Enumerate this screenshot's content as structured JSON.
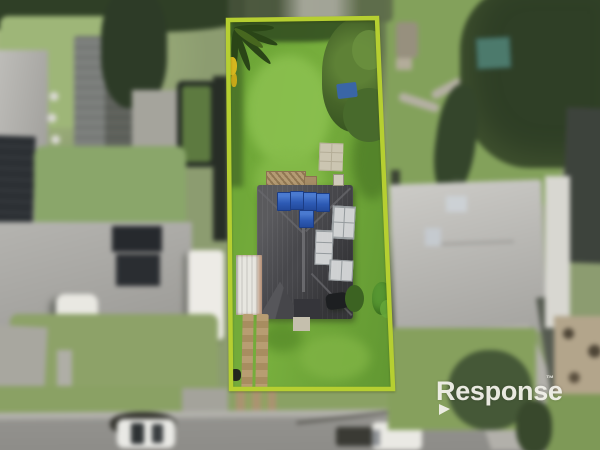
{
  "scene": {
    "kind": "aerial-drone-photograph",
    "subject": "residential lot highlighted with a chartreuse boundary outline; house with blue solar panels, white carport, large green lawns, dirt driveway; neighbouring houses, backyard pool, caravans, street with parked white car and ute at bottom",
    "elements": [
      "subject-lot",
      "subject-house-roof",
      "blue-solar-panels",
      "white-roof-panels",
      "carport",
      "backyard-lawn",
      "front-lawn",
      "dirt-driveway-tracks",
      "palm-tree",
      "boundary-trees",
      "blue-tarp",
      "garden-shed",
      "neighbor-pool",
      "neighbor-house-left",
      "neighbor-house-right",
      "caravan",
      "street",
      "parked-car",
      "parked-ute",
      "tree-shadow"
    ]
  },
  "watermark": {
    "text": "Response",
    "tm": "™"
  },
  "boundary": {
    "points": "228,20 377,18 393,389 231,389"
  },
  "colors": {
    "boundary": "#b6cf31",
    "watermark": "#f2f1ea",
    "lot-lawn": "#6aa335",
    "outside-lawn": "#8c9c70",
    "subject-roof": "#47474b",
    "neighbor-roof-light": "#b8b7b3",
    "solar-panel-blue": "#2d5ab4",
    "pool-water": "#5d7a40",
    "trees-dark": "#2f3f26",
    "road": "#8b8a86"
  }
}
